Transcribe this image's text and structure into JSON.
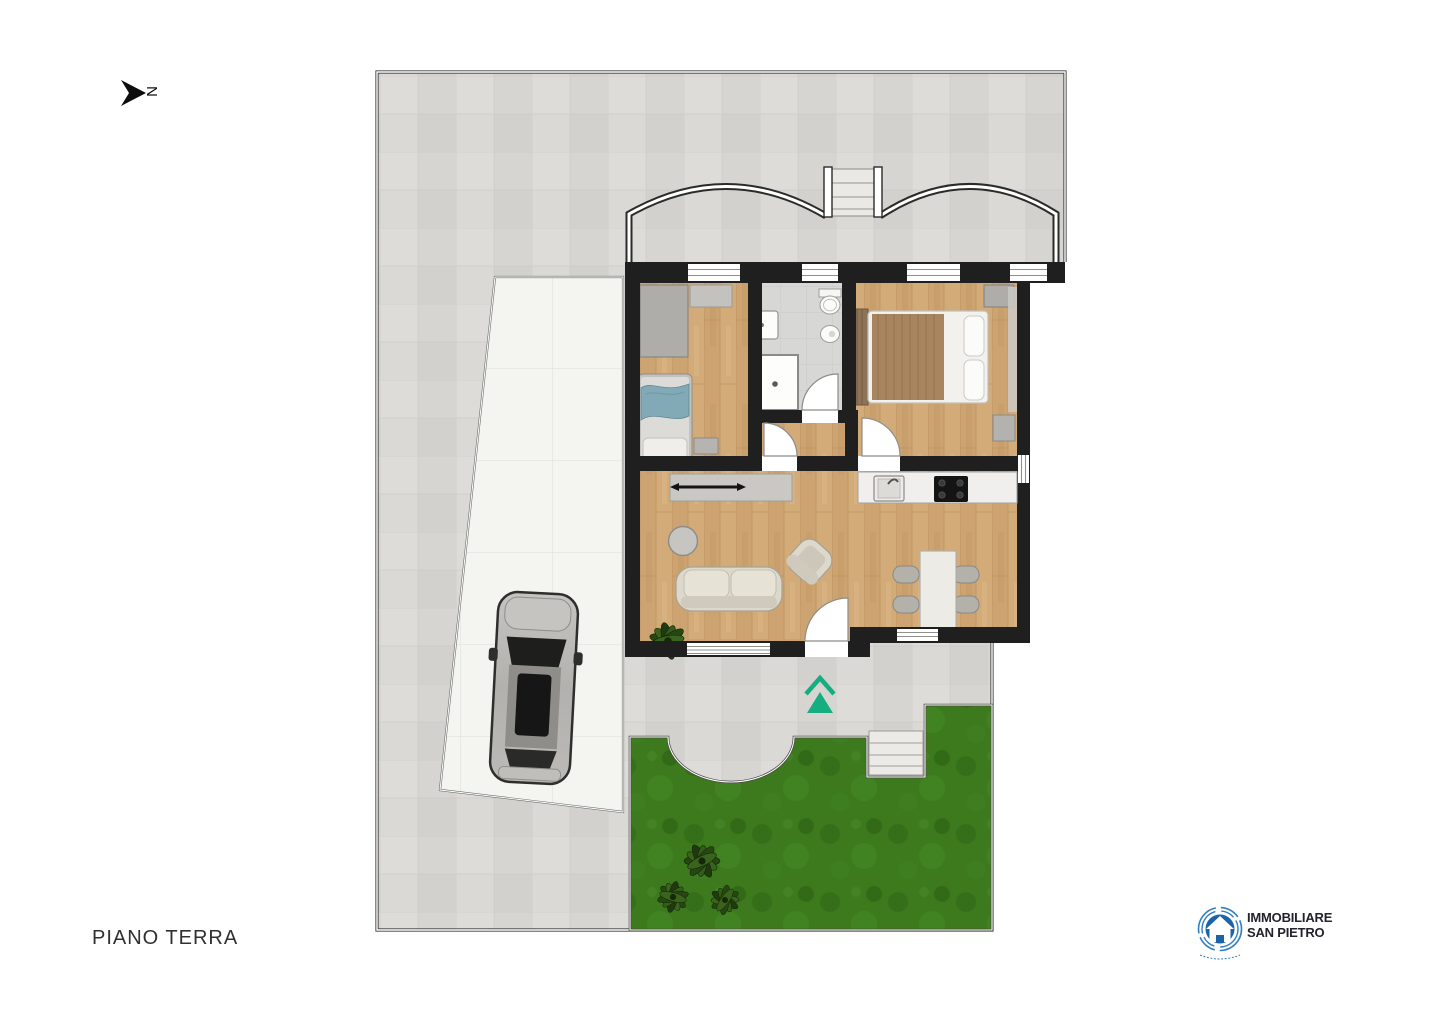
{
  "floor_plan": {
    "label": "PIANO TERRA",
    "north_label": "N"
  },
  "logo": {
    "line1": "IMMOBILIARE",
    "line2": "SAN PIETRO"
  },
  "colors": {
    "background": "#ffffff",
    "walls": "#1f1f1f",
    "wood_floor": "#cda471",
    "tile_paving": "#d8d7d3",
    "driveway": "#f4f4f1",
    "bath_floor": "#d7d7d5",
    "grass": "#3c7a1d",
    "entrance_arrow": "#16ad80",
    "logo_blue": "#1c63a8",
    "label_text": "#303030"
  }
}
